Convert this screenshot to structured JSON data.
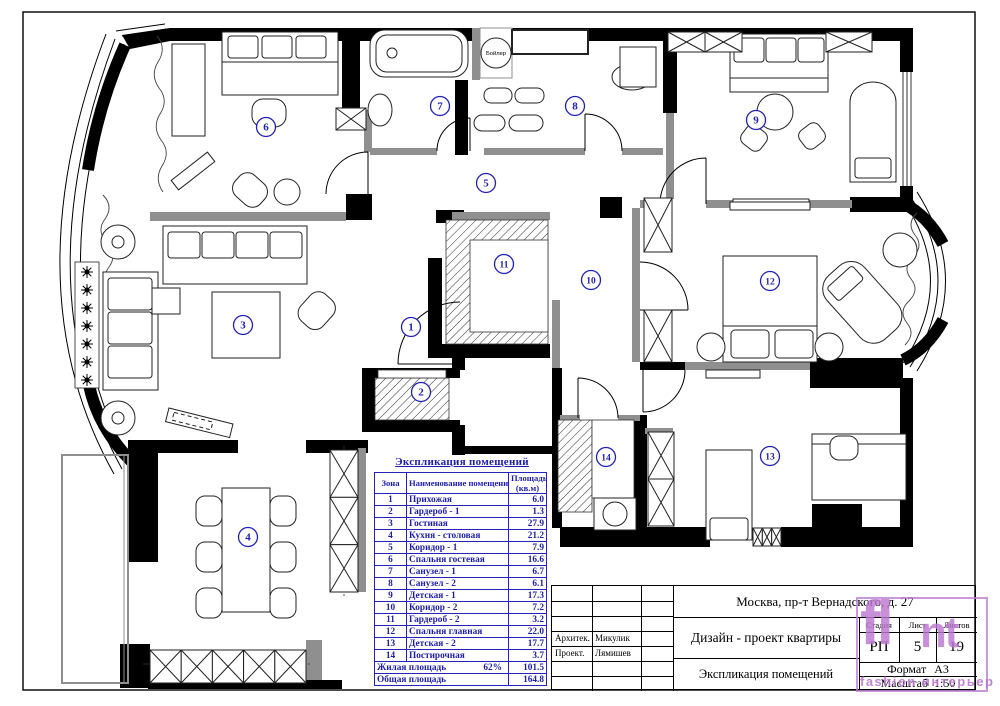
{
  "plan": {
    "boiler_label": "Бойлер",
    "rooms": [
      {
        "zone": "1",
        "name": "Прихожая",
        "area": "6.0",
        "x": 411,
        "y": 327
      },
      {
        "zone": "2",
        "name": "Гардероб - 1",
        "area": "1.3",
        "x": 421,
        "y": 392
      },
      {
        "zone": "3",
        "name": "Гостиная",
        "area": "27.9",
        "x": 243,
        "y": 325
      },
      {
        "zone": "4",
        "name": "Кухня - столовая",
        "area": "21.2",
        "x": 248,
        "y": 537
      },
      {
        "zone": "5",
        "name": "Коридор - 1",
        "area": "7.9",
        "x": 486,
        "y": 183
      },
      {
        "zone": "6",
        "name": "Спальня гостевая",
        "area": "16.6",
        "x": 266,
        "y": 127
      },
      {
        "zone": "7",
        "name": "Санузел - 1",
        "area": "6.7",
        "x": 440,
        "y": 106
      },
      {
        "zone": "8",
        "name": "Санузел - 2",
        "area": "6.1",
        "x": 575,
        "y": 106
      },
      {
        "zone": "9",
        "name": "Детская - 1",
        "area": "17.3",
        "x": 756,
        "y": 120
      },
      {
        "zone": "10",
        "name": "Коридор - 2",
        "area": "7.2",
        "x": 591,
        "y": 280
      },
      {
        "zone": "11",
        "name": "Гардероб - 2",
        "area": "3.2",
        "x": 504,
        "y": 264
      },
      {
        "zone": "12",
        "name": "Спальня главная",
        "area": "22.0",
        "x": 770,
        "y": 281
      },
      {
        "zone": "13",
        "name": "Детская - 2",
        "area": "17.7",
        "x": 770,
        "y": 456
      },
      {
        "zone": "14",
        "name": "Постирочная",
        "area": "3.7",
        "x": 606,
        "y": 457
      }
    ]
  },
  "table": {
    "title": "Экспликация помещений",
    "col_zone": "Зона",
    "col_name": "Наименование помещения",
    "col_area_line1": "Площадь",
    "col_area_line2": "(кв.м)",
    "summary": [
      {
        "name": "Жилая площадь",
        "percent": "62%",
        "area": "101.5"
      },
      {
        "name": "Общая площадь",
        "percent": "",
        "area": "164.8"
      }
    ]
  },
  "title_block": {
    "address": "Москва, пр-т Вернадского, д. 27",
    "project": "Дизайн - проект  квартиры",
    "sheet_title": "Экспликация помещений",
    "roles": [
      {
        "label": "Архитек.",
        "name": "Микулик"
      },
      {
        "label": "Проект.",
        "name": "Лямишев"
      }
    ],
    "stage_label": "Стадия",
    "stage_value": "РП",
    "sheet_label": "Лист",
    "sheet_value": "5",
    "sheets_label": "Листов",
    "sheets_value": "19",
    "format_label": "Формат",
    "format_value": "А3",
    "scale_label": "Масштаб",
    "scale_value": "1:50"
  },
  "watermark": {
    "glyph1": "fl",
    "glyph2": "nt",
    "text": "fashion интерьер",
    "color": "#be7ed2"
  },
  "colors": {
    "table_blue": "#1c1cae",
    "wall_black": "#000000",
    "partition_gray": "#8f8f8f"
  }
}
